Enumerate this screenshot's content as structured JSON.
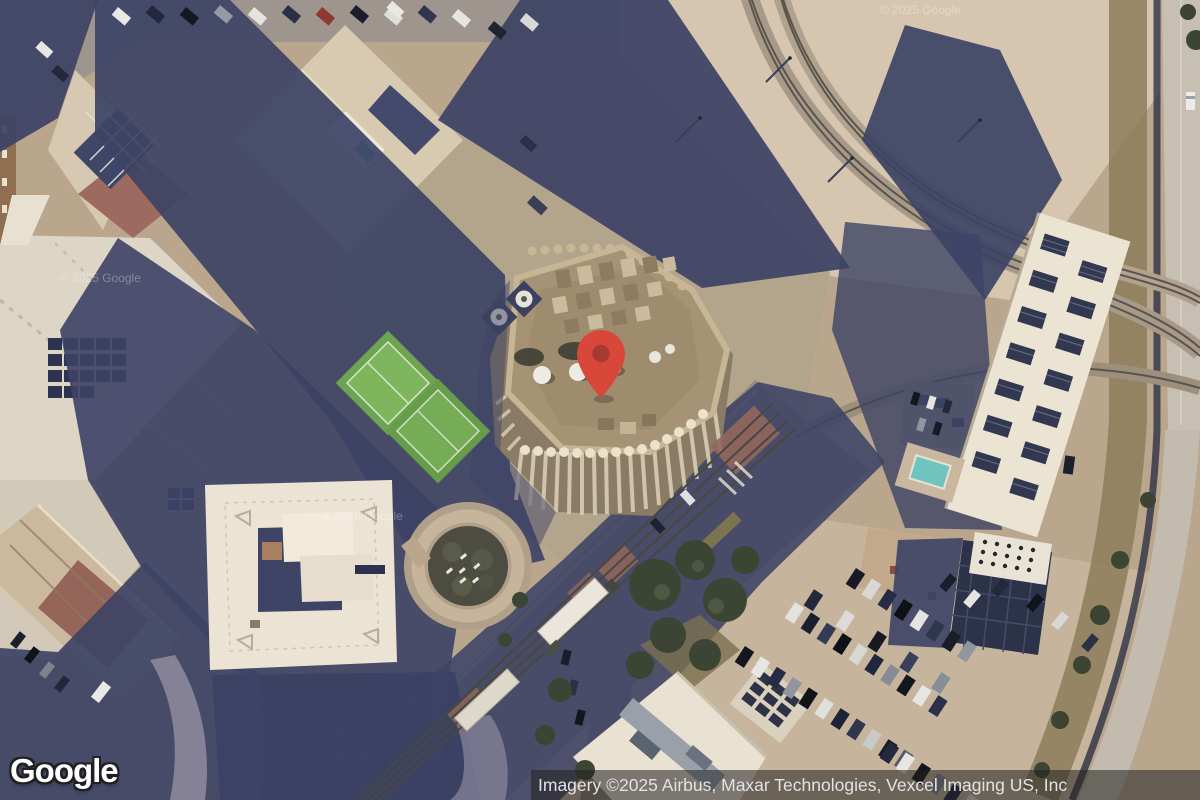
{
  "map": {
    "provider": "Google",
    "view_type": "satellite imagery",
    "logo_text": "Google",
    "attribution_text": "Imagery ©2025 Airbus, Maxar Technologies, Vexcel Imaging US, Inc",
    "watermark_text": "© 2025 Google",
    "marker": {
      "name": "red-location-pin",
      "x": 601,
      "y": 398,
      "pin_color": "#D9473B",
      "pin_dot_color": "#A63A30"
    }
  },
  "colors": {
    "shadow": "#3D4365",
    "pavement_tan": "#B9A68D",
    "lot_light": "#D7C6AF",
    "attribution_bg": "rgba(32,32,32,0.55)",
    "attribution_text": "#E2E2E2",
    "logo_text": "#FFFFFF"
  }
}
